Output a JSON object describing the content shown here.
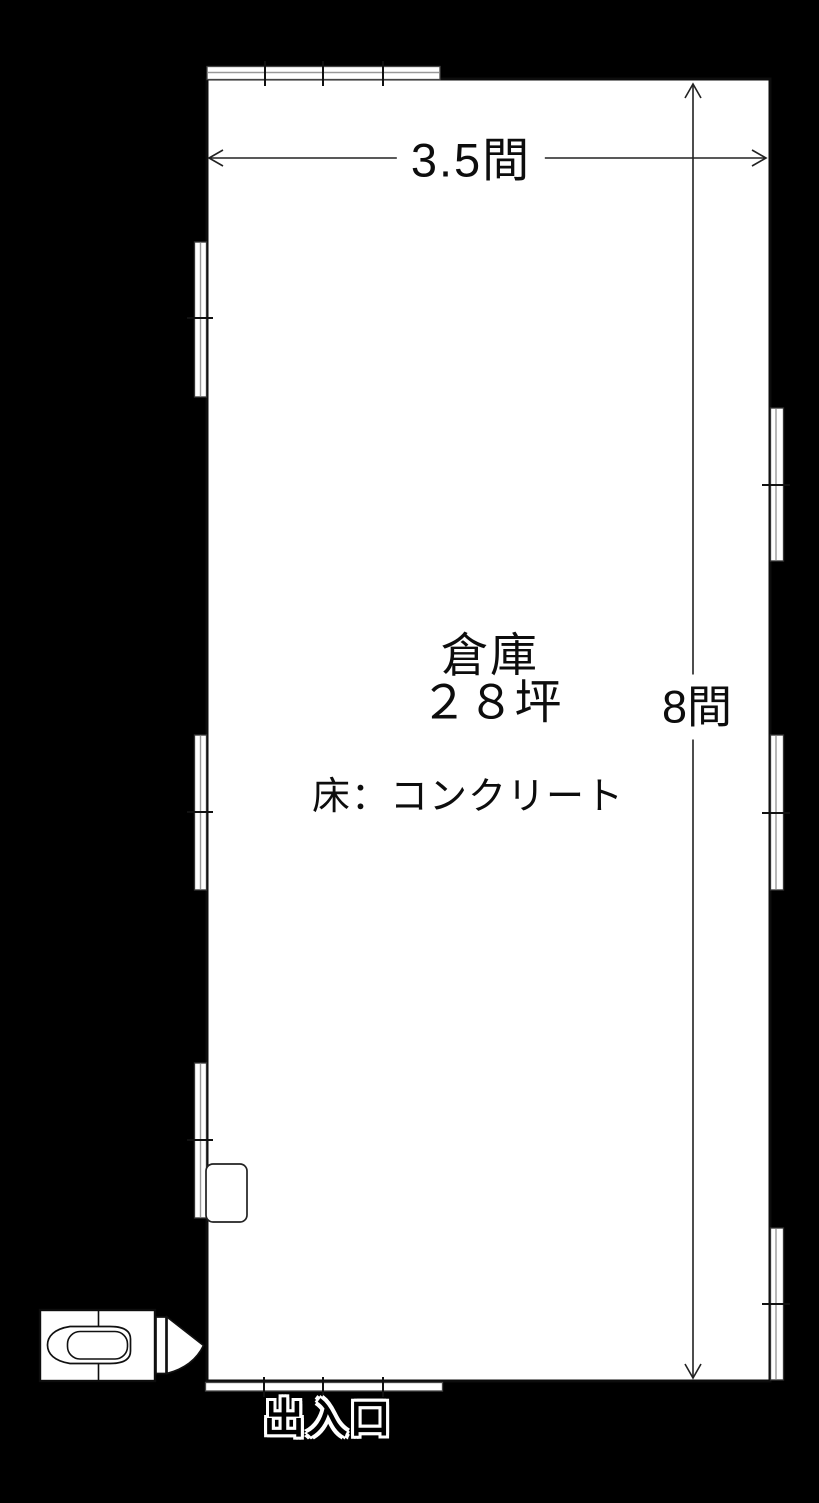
{
  "plan": {
    "type": "floor-plan",
    "room": {
      "name": "倉庫",
      "area": "２８坪",
      "floor_spec": "床：コンクリート"
    },
    "dimensions": {
      "width": "3.5間",
      "height": "8間"
    },
    "entrance": {
      "label": "出入口"
    },
    "colors": {
      "background": "#000000",
      "floor_fill": "#ffffff",
      "line": "#1a1a1a"
    }
  }
}
